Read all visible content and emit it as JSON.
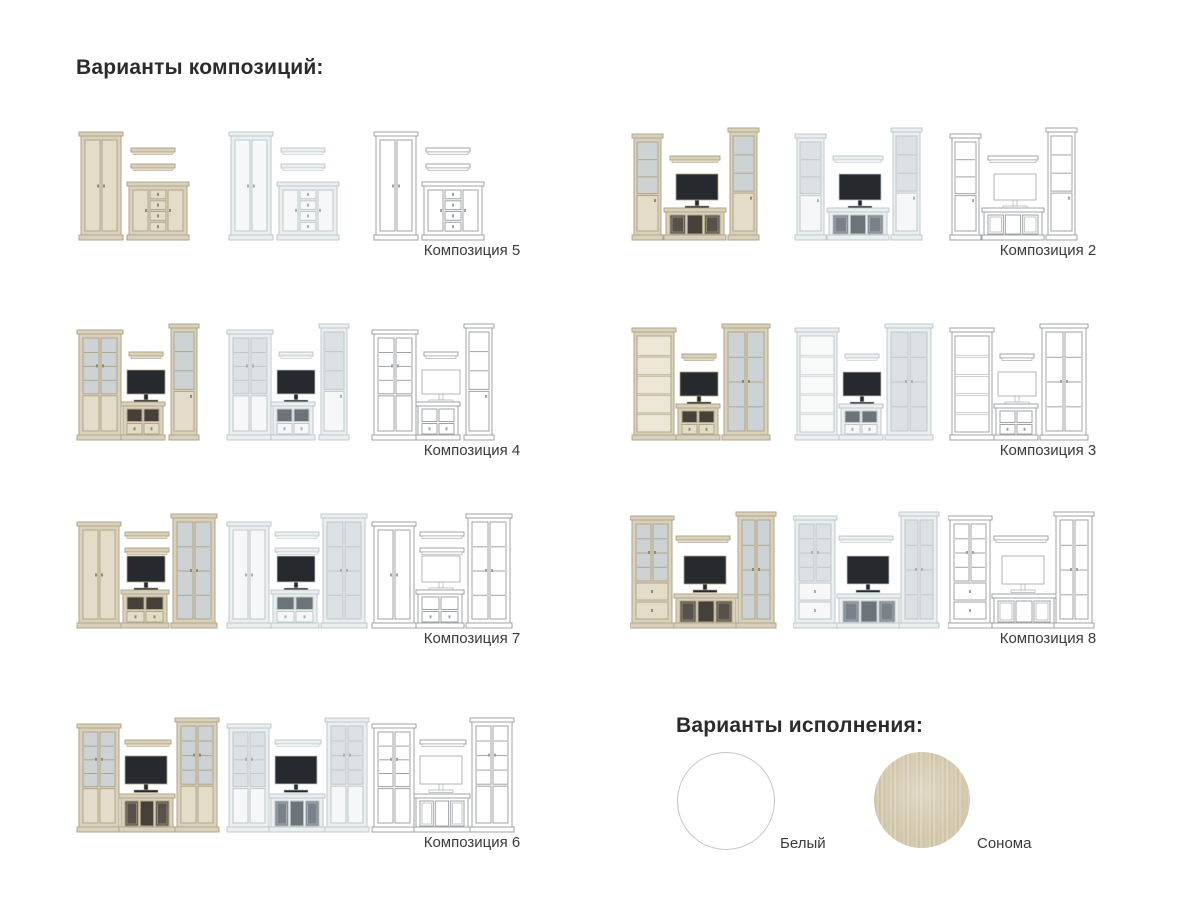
{
  "headings": {
    "compositions": "Варианты композиций:",
    "finishes": "Варианты исполнения:"
  },
  "variants": [
    "sonoma",
    "white",
    "outline"
  ],
  "colors": {
    "background": "#ffffff",
    "heading_text": "#2b2b2b",
    "label_text": "#3a3a3a",
    "white_swatch_border": "#c6c6c6"
  },
  "palettes": {
    "sonoma": {
      "body": "#d9d1bc",
      "panel": "#e3dcc9",
      "edge": "#b1a68a",
      "glass": "#cdd3d4",
      "inner": "#ece6d6",
      "dark": "#26292d",
      "knob": "#93896f",
      "open": "#45403a",
      "gdark": "#56524b"
    },
    "white": {
      "body": "#eceff0",
      "panel": "#f5f7f8",
      "edge": "#c0c8cc",
      "glass": "#dbe1e4",
      "inner": "#f8fafa",
      "dark": "#26292d",
      "knob": "#a9b1b5",
      "open": "#6b7478",
      "gdark": "#79828a"
    },
    "outline": {
      "body": "#ffffff",
      "panel": "#ffffff",
      "edge": "#9fa3a6",
      "glass": "#ffffff",
      "inner": "#ffffff",
      "dark": "#ffffff",
      "knob": "#9fa3a6",
      "open": "#ffffff",
      "gdark": "#ffffff"
    }
  },
  "compositions": [
    {
      "label": "Композиция 5",
      "col": 0,
      "row": 0,
      "pieces": [
        {
          "t": "wardrobe",
          "x": 6,
          "y": 14,
          "w": 40,
          "h": 108
        },
        {
          "t": "shelf",
          "x": 56,
          "y": 30,
          "w": 44,
          "h": 6
        },
        {
          "t": "shelf",
          "x": 56,
          "y": 46,
          "w": 44,
          "h": 6
        },
        {
          "t": "commode",
          "x": 54,
          "y": 64,
          "w": 58,
          "h": 58
        }
      ]
    },
    {
      "label": "Композиция 2",
      "col": 1,
      "row": 0,
      "pieces": [
        {
          "t": "glass1",
          "x": 4,
          "y": 16,
          "w": 27,
          "h": 106
        },
        {
          "t": "shelf",
          "x": 40,
          "y": 38,
          "w": 50,
          "h": 6
        },
        {
          "t": "tv",
          "x": 46,
          "y": 56,
          "w": 42,
          "h": 26
        },
        {
          "t": "lowcab",
          "x": 36,
          "y": 90,
          "w": 58,
          "h": 32,
          "o": {
            "seg": [
              "g",
              "o",
              "g"
            ]
          }
        },
        {
          "t": "glass1",
          "x": 100,
          "y": 10,
          "w": 27,
          "h": 112
        }
      ]
    },
    {
      "label": "Композиция 4",
      "col": 0,
      "row": 1,
      "pieces": [
        {
          "t": "glass2",
          "x": 4,
          "y": 12,
          "w": 42,
          "h": 110,
          "o": {
            "bottom": "solid"
          }
        },
        {
          "t": "shelf",
          "x": 54,
          "y": 34,
          "w": 34,
          "h": 6
        },
        {
          "t": "tv",
          "x": 52,
          "y": 52,
          "w": 38,
          "h": 24
        },
        {
          "t": "lowcab",
          "x": 48,
          "y": 84,
          "w": 40,
          "h": 38,
          "o": {
            "seg": [
              "o",
              "o"
            ],
            "drawers": 2
          }
        },
        {
          "t": "glass1",
          "x": 96,
          "y": 6,
          "w": 26,
          "h": 116
        }
      ]
    },
    {
      "label": "Композиция 3",
      "col": 1,
      "row": 1,
      "pieces": [
        {
          "t": "bookcase",
          "x": 4,
          "y": 10,
          "w": 40,
          "h": 112
        },
        {
          "t": "shelf",
          "x": 52,
          "y": 36,
          "w": 34,
          "h": 6
        },
        {
          "t": "tv",
          "x": 50,
          "y": 54,
          "w": 38,
          "h": 24
        },
        {
          "t": "lowcab",
          "x": 48,
          "y": 86,
          "w": 40,
          "h": 36,
          "o": {
            "seg": [
              "o",
              "o"
            ],
            "drawers": 2
          }
        },
        {
          "t": "glass2",
          "x": 94,
          "y": 6,
          "w": 44,
          "h": 116,
          "o": {
            "bottom": "none"
          }
        }
      ]
    },
    {
      "label": "Композиция 7",
      "col": 0,
      "row": 2,
      "pieces": [
        {
          "t": "wardrobe",
          "x": 4,
          "y": 16,
          "w": 40,
          "h": 106
        },
        {
          "t": "shelf",
          "x": 50,
          "y": 26,
          "w": 44,
          "h": 6
        },
        {
          "t": "shelf",
          "x": 50,
          "y": 42,
          "w": 44,
          "h": 6
        },
        {
          "t": "tv",
          "x": 52,
          "y": 50,
          "w": 38,
          "h": 26
        },
        {
          "t": "lowcab",
          "x": 48,
          "y": 84,
          "w": 44,
          "h": 38,
          "o": {
            "seg": [
              "o",
              "o"
            ],
            "drawers": 2
          }
        },
        {
          "t": "glass2",
          "x": 98,
          "y": 8,
          "w": 42,
          "h": 114,
          "o": {
            "bottom": "none"
          }
        }
      ]
    },
    {
      "label": "Композиция 8",
      "col": 1,
      "row": 2,
      "pieces": [
        {
          "t": "glass2",
          "x": 2,
          "y": 10,
          "w": 40,
          "h": 112,
          "o": {
            "bottom": "drawers"
          }
        },
        {
          "t": "shelf",
          "x": 46,
          "y": 30,
          "w": 54,
          "h": 6
        },
        {
          "t": "tv",
          "x": 54,
          "y": 50,
          "w": 42,
          "h": 28
        },
        {
          "t": "lowcab",
          "x": 46,
          "y": 88,
          "w": 60,
          "h": 34,
          "o": {
            "seg": [
              "g",
              "o",
              "g"
            ]
          }
        },
        {
          "t": "glass2",
          "x": 108,
          "y": 6,
          "w": 36,
          "h": 116,
          "o": {
            "bottom": "none"
          }
        }
      ]
    },
    {
      "label": "Композиция 6",
      "col": 0,
      "row": 3,
      "pieces": [
        {
          "t": "glass2",
          "x": 4,
          "y": 14,
          "w": 40,
          "h": 108,
          "o": {
            "bottom": "solid"
          }
        },
        {
          "t": "shelf",
          "x": 50,
          "y": 30,
          "w": 46,
          "h": 6
        },
        {
          "t": "tv",
          "x": 50,
          "y": 46,
          "w": 42,
          "h": 28
        },
        {
          "t": "lowcab",
          "x": 46,
          "y": 84,
          "w": 52,
          "h": 38,
          "o": {
            "seg": [
              "g",
              "o",
              "g"
            ]
          }
        },
        {
          "t": "glass2",
          "x": 102,
          "y": 8,
          "w": 40,
          "h": 114,
          "o": {
            "bottom": "solid"
          }
        }
      ]
    }
  ],
  "finishes": [
    {
      "label": "Белый",
      "finish": "white"
    },
    {
      "label": "Сонома",
      "finish": "sonoma"
    }
  ]
}
